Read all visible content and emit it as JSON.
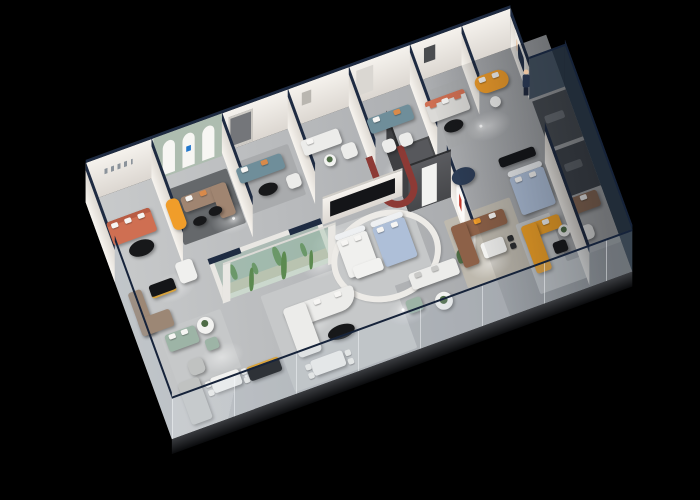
{
  "meta": {
    "title": "Isometric 3D cutaway render of a furniture showroom floor plan",
    "background": "#000000",
    "projection": "plan-oblique axonometric, plan rotated -20 degrees",
    "lighting": "ceiling spotlights pooling on grey floor"
  },
  "palette": {
    "background": "#000000",
    "floor_light": "#c9cbcc",
    "floor": "#b7b9bb",
    "floor_dark": "#8f9296",
    "slab_edge_top": "#3a3c40",
    "slab_edge_bottom": "#0a0b0d",
    "wall_white": "#f1eee9",
    "wall_shadow": "#dcd7d1",
    "wall_cap_navy": "#1e2b42",
    "glass_tint": "rgba(165,185,200,0.18)",
    "glass_dark": "rgba(40,54,68,0.82)",
    "glass_rail": "#16233a",
    "rug_dark": "#65686b",
    "rug_mid": "#a9abad",
    "rug_light": "#c6c8c9",
    "rug_beige": "#beb9ae",
    "sofa_coral": "#cf6f52",
    "sofa_coral_dark": "#b85c44",
    "sofa_orange": "#f09d2a",
    "sofa_yellow": "#f2a226",
    "sofa_brown": "#a08571",
    "sofa_leather": "#8d6148",
    "sofa_tan": "#9c8775",
    "sofa_walnut": "#8a6a55",
    "sofa_teal": "#6f8e9a",
    "sofa_sage": "#9db4a6",
    "sofa_white": "#ececea",
    "sofa_grey": "#c0c2c1",
    "pillow_white": "#f6f5f3",
    "pillow_orange": "#d98a4a",
    "table_black": "#17181a",
    "table_white": "#f2f2f0",
    "bed_white": "#f0f0ee",
    "bed_blue": "#aebfd8",
    "headboard_white": "#eef0f2",
    "arch_wall_sage": "#aebdb0",
    "arch_white": "#f7f6f3",
    "logo_blue": "#2277cc",
    "logo_red": "#c23b2e",
    "feature_wall_top": "#57585c",
    "feature_wall_face": "#4a4b4d",
    "feature_door": "#f2f2f0",
    "ribbon_red": "#8d3a35",
    "ottoman_navy": "#2c3c55",
    "terrarium_glass": "rgba(140,185,160,0.32)",
    "terrarium_sand": "#cfc9b8",
    "cactus_green": "#5c8a50",
    "plant_green": "#4d6b45",
    "console_black": "#141518",
    "console_stripe": "#d7a23c",
    "person_suit": "#25324a",
    "person_skin": "#e8c19e",
    "room_dark": "#474c52",
    "room_dark2": "#3e434a"
  },
  "scene": {
    "zones": [
      {
        "id": "corner-lounge",
        "items": [
          "coral fabric sofa with white cushions",
          "black oval coffee table",
          "wall signage strip"
        ]
      },
      {
        "id": "arch-gallery",
        "items": [
          "sage wall with three white arches and blue logo",
          "brown corner sofa",
          "orange chaise lounge",
          "two black coffee tables",
          "dark grey rug"
        ]
      },
      {
        "id": "teal-lounge",
        "items": [
          "teal sofa with white and orange cushions",
          "black oval coffee table",
          "white armchair",
          "dark wall niche"
        ]
      },
      {
        "id": "white-nook",
        "items": [
          "white high-back sofa",
          "white armchair",
          "round side table with plant"
        ]
      },
      {
        "id": "teal-lounge-2",
        "items": [
          "teal sofa",
          "two white armchairs",
          "black coffee table"
        ]
      },
      {
        "id": "ribbon-display",
        "items": [
          "red U-shaped display ribbon",
          "charcoal feature wall with white door",
          "navy round ottoman"
        ]
      },
      {
        "id": "coral-accent-lounge",
        "items": [
          "light sofa with coral cushions",
          "black oval coffee table"
        ]
      },
      {
        "id": "reception-corner",
        "items": [
          "curved orange sofa",
          "white round table",
          "staff poster",
          "standing salesperson"
        ]
      },
      {
        "id": "terrarium",
        "items": [
          "glass cactus terrarium with white frame and navy top caps"
        ]
      },
      {
        "id": "bedding-display",
        "items": [
          "black TV console wall",
          "white bed",
          "blue bed",
          "curved white partition"
        ]
      },
      {
        "id": "west-storefront",
        "items": [
          "white lounge chair",
          "taupe corner sofa",
          "black sideboard with brass stripe",
          "sage green sofa",
          "sage ottoman",
          "grey armchair",
          "round flower table",
          "white dining table with chairs",
          "grey corner sofa",
          "black media console with brass stripe"
        ]
      },
      {
        "id": "center-living",
        "items": [
          "white curved sectional sofa",
          "black oval coffee table",
          "white dining table with chairs",
          "white low cabinet"
        ]
      },
      {
        "id": "south-lounge",
        "items": [
          "white sofa",
          "sage ottoman",
          "round table with plant",
          "potted plant"
        ]
      },
      {
        "id": "leather-lounge",
        "items": [
          "brown leather sectional with orange pillow",
          "white dining table",
          "niche wall with red logo"
        ]
      },
      {
        "id": "blue-bedroom",
        "items": [
          "blue bed with white headboard",
          "black TV slab"
        ]
      },
      {
        "id": "yellow-lounge",
        "items": [
          "yellow sectional sofa with white cushions",
          "black side table"
        ]
      },
      {
        "id": "east-gallery",
        "items": [
          "dark glass partition rooms",
          "walnut sofa with white cushions",
          "white armchair",
          "round plant table"
        ]
      },
      {
        "id": "glazing",
        "items": [
          "frameless glass walls with navy top rail on west, south and east sides"
        ]
      }
    ]
  }
}
